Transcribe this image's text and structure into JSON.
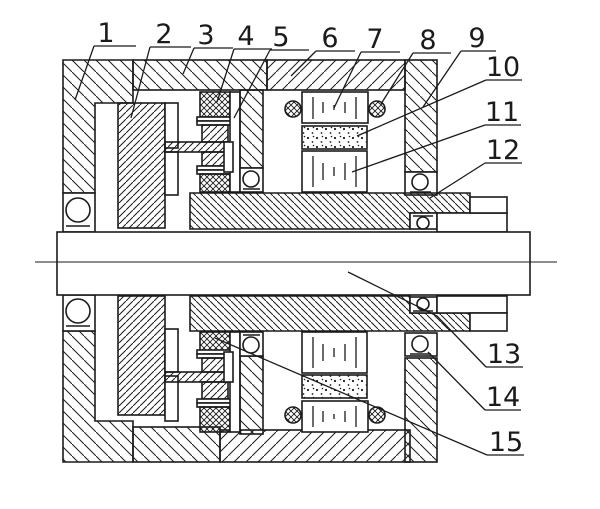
{
  "figure": {
    "background": "#ffffff",
    "line_color": "#1b1b1b",
    "labels": [
      {
        "n": "1",
        "tx": 106,
        "ty": 42,
        "tick": [
          94,
          46,
          136,
          46
        ],
        "leader": [
          [
            94,
            46
          ],
          [
            75,
            100
          ]
        ]
      },
      {
        "n": "2",
        "tx": 164,
        "ty": 43,
        "tick": [
          150,
          47,
          191,
          47
        ],
        "leader": [
          [
            150,
            47
          ],
          [
            131,
            118
          ]
        ]
      },
      {
        "n": "3",
        "tx": 206,
        "ty": 44,
        "tick": [
          194,
          48,
          233,
          48
        ],
        "leader": [
          [
            194,
            48
          ],
          [
            183,
            74
          ]
        ]
      },
      {
        "n": "4",
        "tx": 246,
        "ty": 45,
        "tick": [
          234,
          49,
          272,
          49
        ],
        "leader": [
          [
            234,
            49
          ],
          [
            217,
            102
          ]
        ]
      },
      {
        "n": "5",
        "tx": 281,
        "ty": 46,
        "tick": [
          270,
          50,
          309,
          50
        ],
        "leader": [
          [
            270,
            50
          ],
          [
            234,
            118
          ]
        ]
      },
      {
        "n": "6",
        "tx": 330,
        "ty": 47,
        "tick": [
          316,
          51,
          355,
          51
        ],
        "leader": [
          [
            316,
            51
          ],
          [
            291,
            76
          ]
        ]
      },
      {
        "n": "7",
        "tx": 375,
        "ty": 48,
        "tick": [
          361,
          52,
          400,
          52
        ],
        "leader": [
          [
            361,
            52
          ],
          [
            334,
            108
          ]
        ]
      },
      {
        "n": "8",
        "tx": 428,
        "ty": 49,
        "tick": [
          413,
          53,
          451,
          53
        ],
        "leader": [
          [
            413,
            53
          ],
          [
            381,
            104
          ]
        ]
      },
      {
        "n": "9",
        "tx": 477,
        "ty": 47,
        "tick": [
          461,
          51,
          496,
          51
        ],
        "leader": [
          [
            461,
            51
          ],
          [
            423,
            107
          ]
        ]
      },
      {
        "n": "10",
        "tx": 503,
        "ty": 76,
        "tick": [
          486,
          80,
          522,
          80
        ],
        "leader": [
          [
            486,
            80
          ],
          [
            357,
            136
          ]
        ]
      },
      {
        "n": "11",
        "tx": 502,
        "ty": 121,
        "tick": [
          485,
          125,
          521,
          125
        ],
        "leader": [
          [
            485,
            125
          ],
          [
            352,
            172
          ]
        ]
      },
      {
        "n": "12",
        "tx": 503,
        "ty": 159,
        "tick": [
          485,
          163,
          522,
          163
        ],
        "leader": [
          [
            485,
            163
          ],
          [
            430,
            198
          ]
        ]
      },
      {
        "n": "13",
        "tx": 504,
        "ty": 363,
        "tick": [
          486,
          367,
          523,
          367
        ],
        "leader": [
          [
            486,
            367
          ],
          [
            437,
            316
          ],
          [
            348,
            272
          ]
        ]
      },
      {
        "n": "14",
        "tx": 503,
        "ty": 406,
        "tick": [
          485,
          410,
          521,
          410
        ],
        "leader": [
          [
            485,
            410
          ],
          [
            428,
            352
          ]
        ]
      },
      {
        "n": "15",
        "tx": 506,
        "ty": 451,
        "tick": [
          487,
          455,
          524,
          455
        ],
        "leader": [
          [
            487,
            455
          ],
          [
            215,
            338
          ]
        ]
      }
    ]
  }
}
